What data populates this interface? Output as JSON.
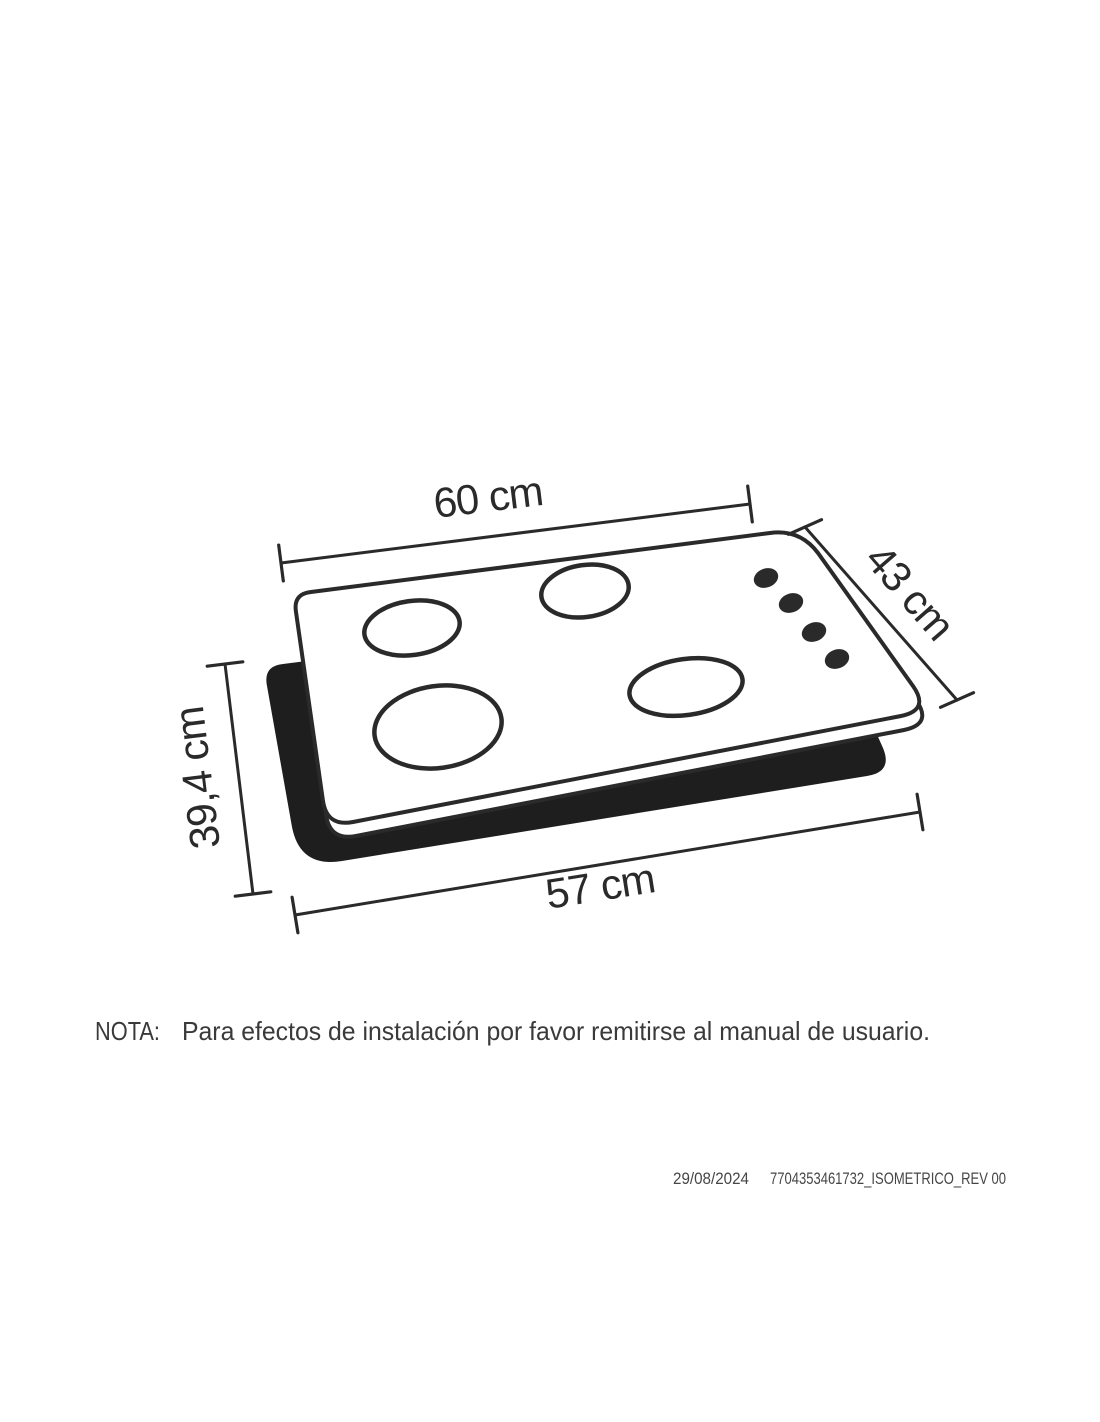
{
  "colors": {
    "paper": "#ffffff",
    "ink": "#2a2a2a",
    "pad": "#1e1e1e",
    "note": "#3a3a3a",
    "footer": "#464646"
  },
  "diagram": {
    "type": "isometric-installation-drawing",
    "subject": "4-burner gas cooktop over countertop cutout",
    "burner_count": 4,
    "knob_count": 4,
    "dimensions": {
      "top_width": "60 cm",
      "side_depth": "43 cm",
      "cutout_depth": "39,4 cm",
      "cutout_width": "57 cm"
    }
  },
  "note": {
    "label": "NOTA:",
    "text": "Para efectos de instalación por favor remitirse al manual de usuario."
  },
  "footer": {
    "date": "29/08/2024",
    "document_id": "7704353461732_ISOMETRICO_REV 00"
  }
}
